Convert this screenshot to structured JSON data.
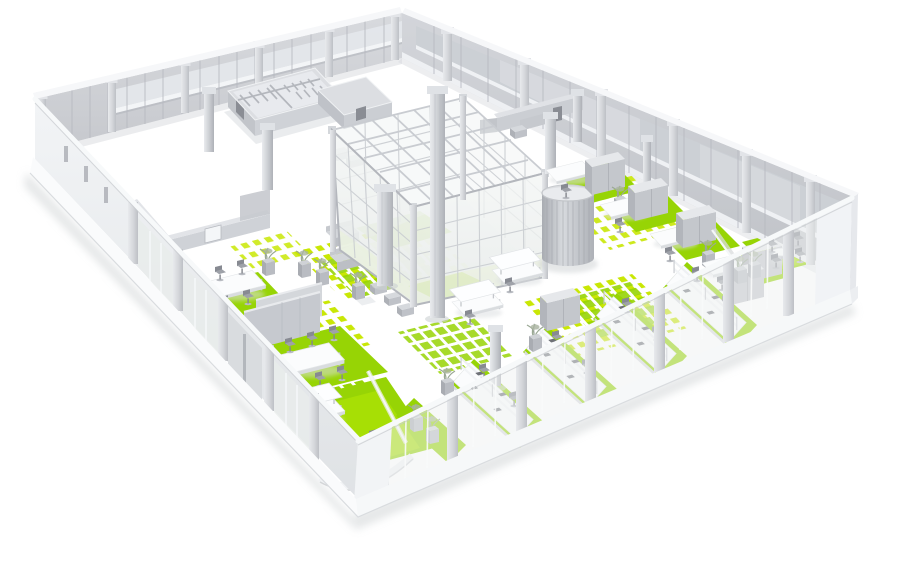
{
  "meta": {
    "title": "3D office floor plan render",
    "description": "Isometric 3D architectural rendering of an open office floor: light gray perimeter walls with window bands and piers, a central glass atrium cube, a cylindrical slatted pod, bright lime-green carpet islands with pixel-mosaic fringes, washroom block, meeting rooms, cubicle bays, workstation rows, round tables, sofas, planters and columns on a white background"
  },
  "colors": {
    "floor": "#ffffff",
    "green": "#97d405",
    "green_bright": "#b5e805",
    "green_dot": "#c9e705",
    "green_soft": "#cfe5a2",
    "wall_light": "#e6e8eb",
    "wall_mid": "#c9cbd0",
    "wall_dark": "#b2b5bb",
    "wall_deep": "#9ea1a8",
    "rim_white": "#f6f7f9",
    "mullion": "#b6b9bf",
    "glass": "#eef1f0",
    "glass_tint": "#eaf2d8",
    "furniture_white": "#fbfcfd",
    "furniture_gray": "#c6c9ce",
    "seat_gray": "#9a9da4",
    "plant": "#9aa894",
    "shadow": "#ccd0d2",
    "doorway_dark": "#8a8d94"
  },
  "scene": {
    "style": "isometric-3d-architectural-render",
    "floor": {
      "shape": "rotated-rectangle",
      "corners": [
        "west",
        "north",
        "east",
        "south"
      ],
      "finish": "white with lime-green carpet islands and pixel-dot mosaic fringes"
    },
    "walls": {
      "back_left": "window wall with piers and sill band",
      "back_right": "window wall with piers and glazing",
      "front_left": "low wall: solid segment with slit windows, then piers with glass and a door",
      "front_right": "glazed wall with piers, white top rail and solid corner block",
      "plinth": "white base band with soft ground shadow"
    },
    "structures": [
      {
        "name": "washroom-block",
        "detail": "extruded walls with small stall partitions and dark doorway"
      },
      {
        "name": "annex-room",
        "detail": "small room block beside washrooms"
      },
      {
        "name": "north-office-room",
        "detail": "enclosed office with L-partition and doorway"
      },
      {
        "name": "west-room",
        "detail": "room with white door leaf near left wing"
      },
      {
        "name": "glass-atrium",
        "detail": "large glazed cube with mullion grid, roof beams and corner columns"
      },
      {
        "name": "cylinder-pod",
        "detail": "round slatted privacy pod"
      },
      {
        "name": "columns",
        "count": 7
      }
    ],
    "furniture": {
      "cubicle_bays": 4,
      "workstation_rows": 4,
      "conference_tables": 2,
      "round_tables": 2,
      "canopy_tables": 3,
      "sofas": 2,
      "ottomans": 3,
      "partition_panels": 2,
      "planters": 8,
      "office_chairs": 26
    }
  }
}
